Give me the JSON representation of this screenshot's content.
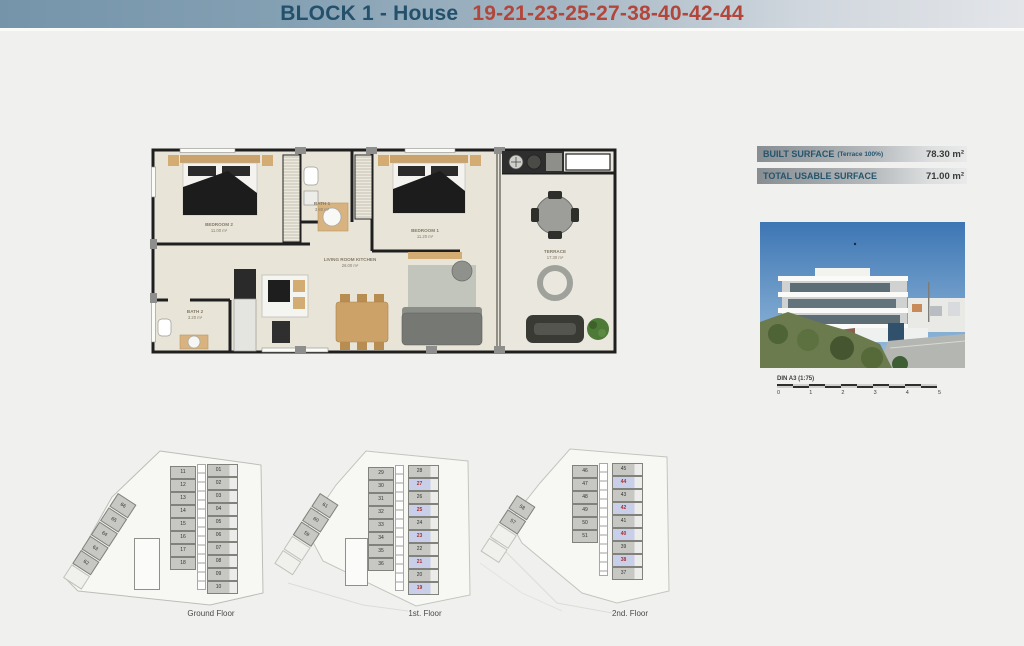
{
  "header": {
    "title_prefix": "BLOCK 1 - House",
    "title_numbers": "19-21-23-25-27-38-40-42-44"
  },
  "surface_table": {
    "rows": [
      {
        "label": "BUILT SURFACE",
        "note": "(Terrace 100%)",
        "value": "78.30 m²"
      },
      {
        "label": "TOTAL USABLE SURFACE",
        "note": "",
        "value": "71.00 m²"
      }
    ]
  },
  "floor_plan": {
    "rooms": [
      {
        "name": "BEDROOM 2",
        "area": "11.00 m²"
      },
      {
        "name": "BATH 1",
        "area": "3.80 m²"
      },
      {
        "name": "BEDROOM 1",
        "area": "11.20 m²"
      },
      {
        "name": "LIVING ROOM KITCHEN",
        "area": "26.00 m²"
      },
      {
        "name": "BATH 2",
        "area": "3.20 m²"
      },
      {
        "name": "TERRACE",
        "area": "17.30 m²"
      }
    ]
  },
  "scale_bar": {
    "label": "DIN A3 (1:75)",
    "ticks": [
      "0",
      "1",
      "2",
      "3",
      "4",
      "5"
    ]
  },
  "site_plans": [
    {
      "label": "Ground Floor",
      "wing_units": [
        "66",
        "65",
        "64",
        "63",
        "62"
      ],
      "wing_ghosts": 1,
      "center_units": [
        "11",
        "12",
        "13",
        "14",
        "15",
        "16",
        "17",
        "18"
      ],
      "right_units": [
        {
          "n": "01",
          "hl": false
        },
        {
          "n": "02",
          "hl": false
        },
        {
          "n": "03",
          "hl": false
        },
        {
          "n": "04",
          "hl": false
        },
        {
          "n": "05",
          "hl": false
        },
        {
          "n": "06",
          "hl": false
        },
        {
          "n": "07",
          "hl": false
        },
        {
          "n": "08",
          "hl": false
        },
        {
          "n": "09",
          "hl": false
        },
        {
          "n": "10",
          "hl": false
        }
      ]
    },
    {
      "label": "1st. Floor",
      "wing_units": [
        "61",
        "60",
        "59"
      ],
      "wing_ghosts": 2,
      "center_units": [
        "29",
        "30",
        "31",
        "32",
        "33",
        "34",
        "35",
        "36"
      ],
      "right_units": [
        {
          "n": "28",
          "hl": false
        },
        {
          "n": "27",
          "hl": true
        },
        {
          "n": "26",
          "hl": false
        },
        {
          "n": "25",
          "hl": true
        },
        {
          "n": "24",
          "hl": false
        },
        {
          "n": "23",
          "hl": true
        },
        {
          "n": "22",
          "hl": false
        },
        {
          "n": "21",
          "hl": true
        },
        {
          "n": "20",
          "hl": false
        },
        {
          "n": "19",
          "hl": true
        }
      ]
    },
    {
      "label": "2nd. Floor",
      "wing_units": [
        "58",
        "57"
      ],
      "wing_ghosts": 2,
      "center_units": [
        "46",
        "47",
        "48",
        "49",
        "50",
        "51"
      ],
      "right_units": [
        {
          "n": "45",
          "hl": false
        },
        {
          "n": "44",
          "hl": true
        },
        {
          "n": "43",
          "hl": false
        },
        {
          "n": "42",
          "hl": true
        },
        {
          "n": "41",
          "hl": false
        },
        {
          "n": "40",
          "hl": true
        },
        {
          "n": "39",
          "hl": false
        },
        {
          "n": "38",
          "hl": true
        },
        {
          "n": "37",
          "hl": false
        }
      ]
    }
  ],
  "colors": {
    "header_blue": "#7594aa",
    "title_teal": "#23506b",
    "title_red": "#b2463b",
    "highlight_unit": "#c9cee9",
    "highlight_number": "#a6302c",
    "plan_floor": "#e8e4d8"
  }
}
